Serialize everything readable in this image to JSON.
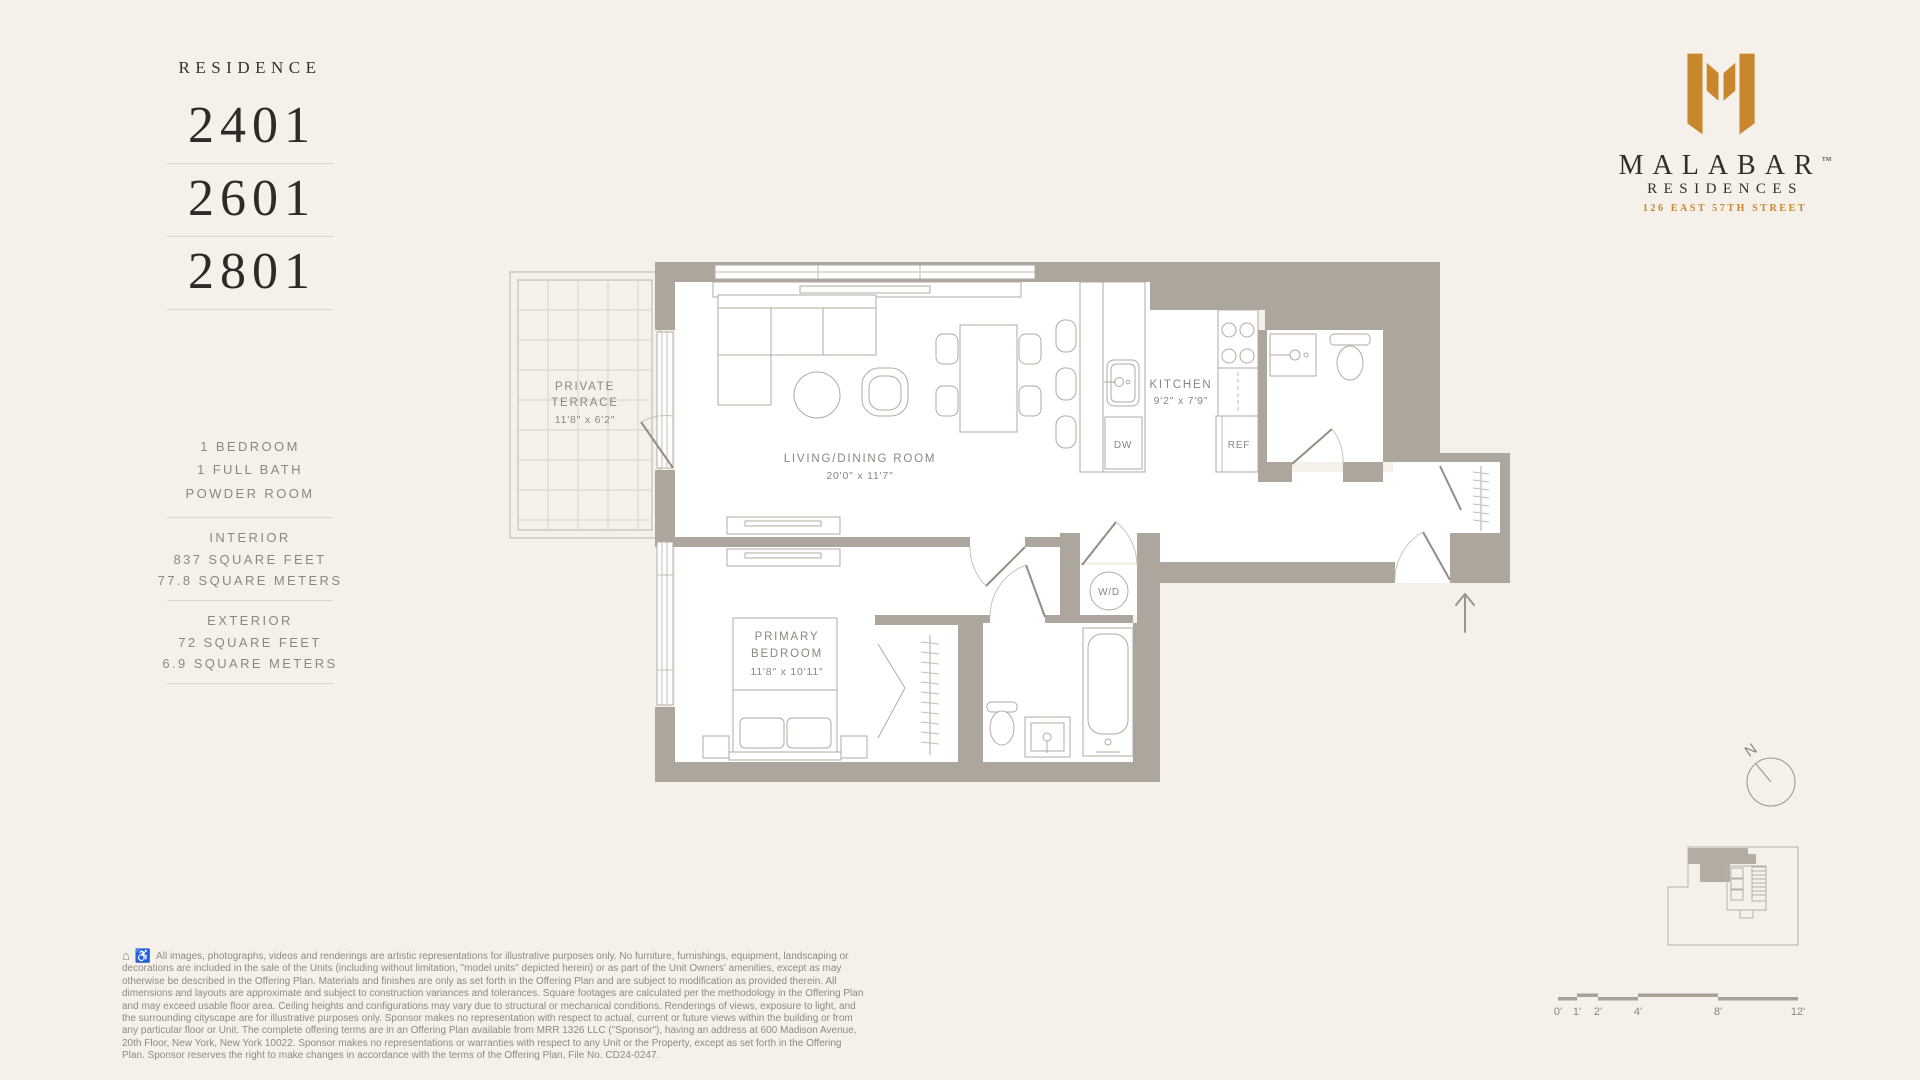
{
  "residence": {
    "label": "RESIDENCE",
    "units": [
      "2401",
      "2601",
      "2801"
    ]
  },
  "details": {
    "rooms": [
      "1 BEDROOM",
      "1 FULL BATH",
      "POWDER ROOM"
    ],
    "interior_title": "INTERIOR",
    "interior_sqft": "837 SQUARE FEET",
    "interior_sqm": "77.8 SQUARE METERS",
    "exterior_title": "EXTERIOR",
    "exterior_sqft": "72 SQUARE FEET",
    "exterior_sqm": "6.9 SQUARE METERS"
  },
  "brand": {
    "name": "MALABAR",
    "tm": "™",
    "sub": "RESIDENCES",
    "address": "126 EAST 57TH STREET",
    "orange": "#c8862d"
  },
  "plan": {
    "terrace_l1": "PRIVATE",
    "terrace_l2": "TERRACE",
    "terrace_dims": "11'8\" x 6'2\"",
    "living_l1": "LIVING/DINING ROOM",
    "living_dims": "20'0\" x 11'7\"",
    "kitchen_l1": "KITCHEN",
    "kitchen_dims": "9'2\" x 7'9\"",
    "bedroom_l1": "PRIMARY",
    "bedroom_l2": "BEDROOM",
    "bedroom_dims": "11'8\" x 10'11\"",
    "wd": "W/D",
    "dw": "DW",
    "ref": "REF"
  },
  "compass": {
    "north": "N"
  },
  "scalebar": {
    "labels": [
      "0'",
      "1'",
      "2'",
      "4'",
      "8'",
      "12'"
    ]
  },
  "disclaimer": {
    "icon_housing": "⌂",
    "icon_access": "♿",
    "text": "All images, photographs, videos and renderings are artistic representations for illustrative purposes only. No furniture, furnishings, equipment, landscaping or decorations are included in the sale of the Units (including without limitation, \"model units\" depicted herein) or as part of the Unit Owners' amenities, except as may otherwise be described in the Offering Plan. Materials and finishes are only as set forth in the Offering Plan and are subject to modification as provided therein. All dimensions and layouts are approximate and subject to construction variances and tolerances. Square footages are calculated per the methodology in the Offering Plan and may exceed usable floor area. Ceiling heights and configurations may vary due to structural or mechanical conditions. Renderings of views, exposure to light, and the surrounding cityscape are for illustrative purposes only. Sponsor makes no representation with respect to actual, current or future views within the building or from any particular floor or Unit. The complete offering terms are in an Offering Plan available from MRR 1326 LLC (\"Sponsor\"), having an address at 600 Madison Avenue, 20th Floor, New York, New York 10022. Sponsor makes no representations or warranties with respect to any Unit or the Property, except as set forth in the Offering Plan. Sponsor reserves the right to make changes in accordance with the terms of the Offering Plan, File No. CD24-0247."
  }
}
